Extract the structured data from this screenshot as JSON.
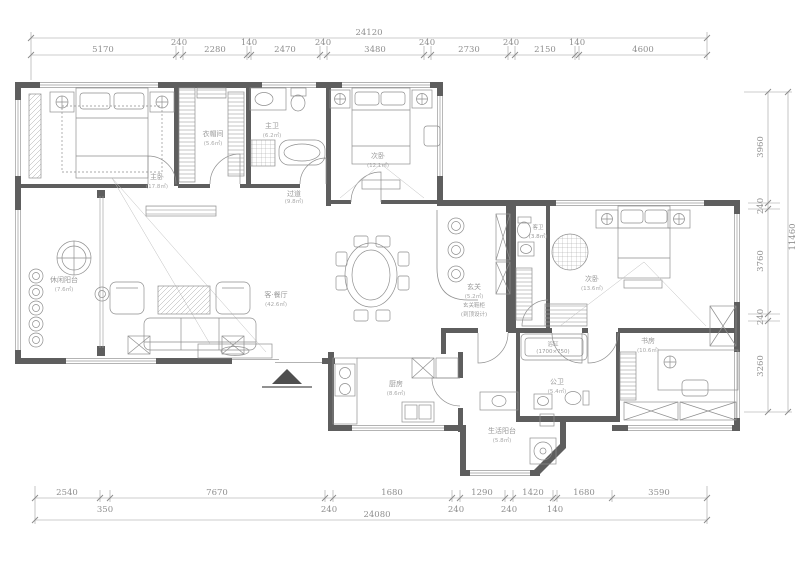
{
  "drawing": {
    "type": "apartment floor plan",
    "colors": {
      "wall": "#5e5e5e",
      "line": "#8f8f8f",
      "dim_text": "#8f8f8f",
      "background": "#ffffff"
    }
  },
  "dimensions": {
    "top": {
      "total": "24120",
      "segments": [
        "5170",
        "240",
        "2280",
        "140",
        "2470",
        "240",
        "3480",
        "240",
        "2730",
        "240",
        "2150",
        "140",
        "4600"
      ]
    },
    "bottom": {
      "total": "24080",
      "segments": [
        "2540",
        "350",
        "7670",
        "240",
        "1680",
        "240",
        "1290",
        "240",
        "1420",
        "140",
        "1680",
        "3590"
      ]
    },
    "right": {
      "total": "11460",
      "segments": [
        "3960",
        "240",
        "3760",
        "240",
        "3260"
      ]
    }
  },
  "rooms": {
    "master_bedroom": {
      "name": "主卧",
      "area": "(17.8㎡)"
    },
    "cloakroom": {
      "name": "衣帽间",
      "area": "(5.6㎡)"
    },
    "master_bath": {
      "name": "主卫",
      "area": "(6.2㎡)"
    },
    "bedroom2": {
      "name": "次卧",
      "area": "(12.1㎡)"
    },
    "hallway": {
      "name": "过道",
      "area": "(9.8㎡)"
    },
    "leisure_balcony": {
      "name": "休闲阳台",
      "area": "(7.6㎡)"
    },
    "living_dining": {
      "name": "客·餐厅",
      "area": "(42.6㎡)"
    },
    "entry": {
      "name": "玄关",
      "area": "(5.2㎡)",
      "note": "玄关鞋柜",
      "note2": "(到顶设计)"
    },
    "guest_bath": {
      "name": "客卫",
      "area": "(3.8㎡)"
    },
    "bedroom3": {
      "name": "次卧",
      "area": "(13.6㎡)"
    },
    "study": {
      "name": "书房",
      "area": "(10.6㎡)"
    },
    "public_bath": {
      "name": "公卫",
      "area": "(5.4㎡)"
    },
    "bathtub": {
      "name": "浴缸",
      "area": "(1700×750)"
    },
    "kitchen": {
      "name": "厨房",
      "area": "(8.6㎡)"
    },
    "service_balcony": {
      "name": "生活阳台",
      "area": "(5.8㎡)"
    }
  }
}
